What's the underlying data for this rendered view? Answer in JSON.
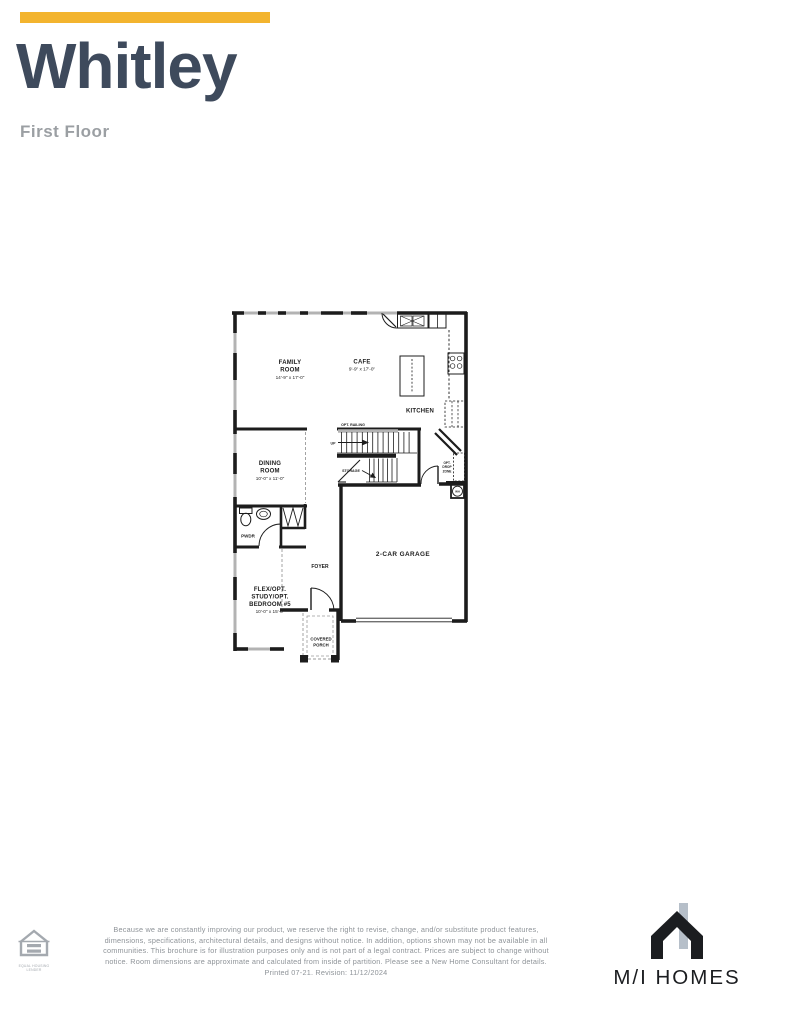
{
  "colors": {
    "accent_gold": "#F3B42E",
    "title_navy": "#3E4A5C",
    "subtitle_gray": "#9B9FA3",
    "plan_line_black": "#1C1C1C",
    "window_gray": "#B3B3B3",
    "disclaimer_gray": "#8E9398",
    "logo_black": "#1B1D20",
    "logo_chimney_gray": "#B6BFC9"
  },
  "header": {
    "title": "Whitley",
    "subtitle": "First Floor"
  },
  "plan": {
    "rooms": {
      "family": {
        "line1": "FAMILY",
        "line2": "ROOM",
        "dims": "14'-9\" x 17'-0\""
      },
      "cafe": {
        "line1": "CAFE",
        "dims": "9'-9\" x 17'-0\""
      },
      "kitchen": {
        "line1": "KITCHEN"
      },
      "dining": {
        "line1": "DINING",
        "line2": "ROOM",
        "dims": "10'-0\" x 11'-0\""
      },
      "powder": {
        "line1": "PWDR"
      },
      "foyer": {
        "line1": "FOYER"
      },
      "garage": {
        "line1": "2-CAR GARAGE"
      },
      "flex": {
        "line1": "FLEX/OPT.",
        "line2": "STUDY/OPT.",
        "line3": "BEDROOM #5",
        "dims": "10'-0\" x 15'-0\""
      },
      "porch": {
        "line1": "COVERED",
        "line2": "PORCH"
      }
    },
    "annotations": {
      "opt_railing": "OPT. RAILING",
      "up": "UP",
      "storage": "STORAGE",
      "drop1": "OPT.",
      "drop2": "DROP",
      "drop3": "ZONE",
      "wh": "WH"
    }
  },
  "footer": {
    "disclaimer": "Because we are constantly improving our product, we reserve the right to revise, change, and/or substitute product features, dimensions, specifications, architectural details, and designs without notice. In addition, options shown may not be available in all communities. This brochure is for illustration purposes only and is not part of a legal contract. Prices are subject to change without notice. Room dimensions are approximate and calculated from inside of partition. Please see a New Home Consultant for details. Printed 07-21. Revision: 11/12/2024",
    "equal_housing": {
      "line1": "EQUAL HOUSING",
      "line2": "LENDER"
    },
    "brand": "M/I HOMES"
  }
}
